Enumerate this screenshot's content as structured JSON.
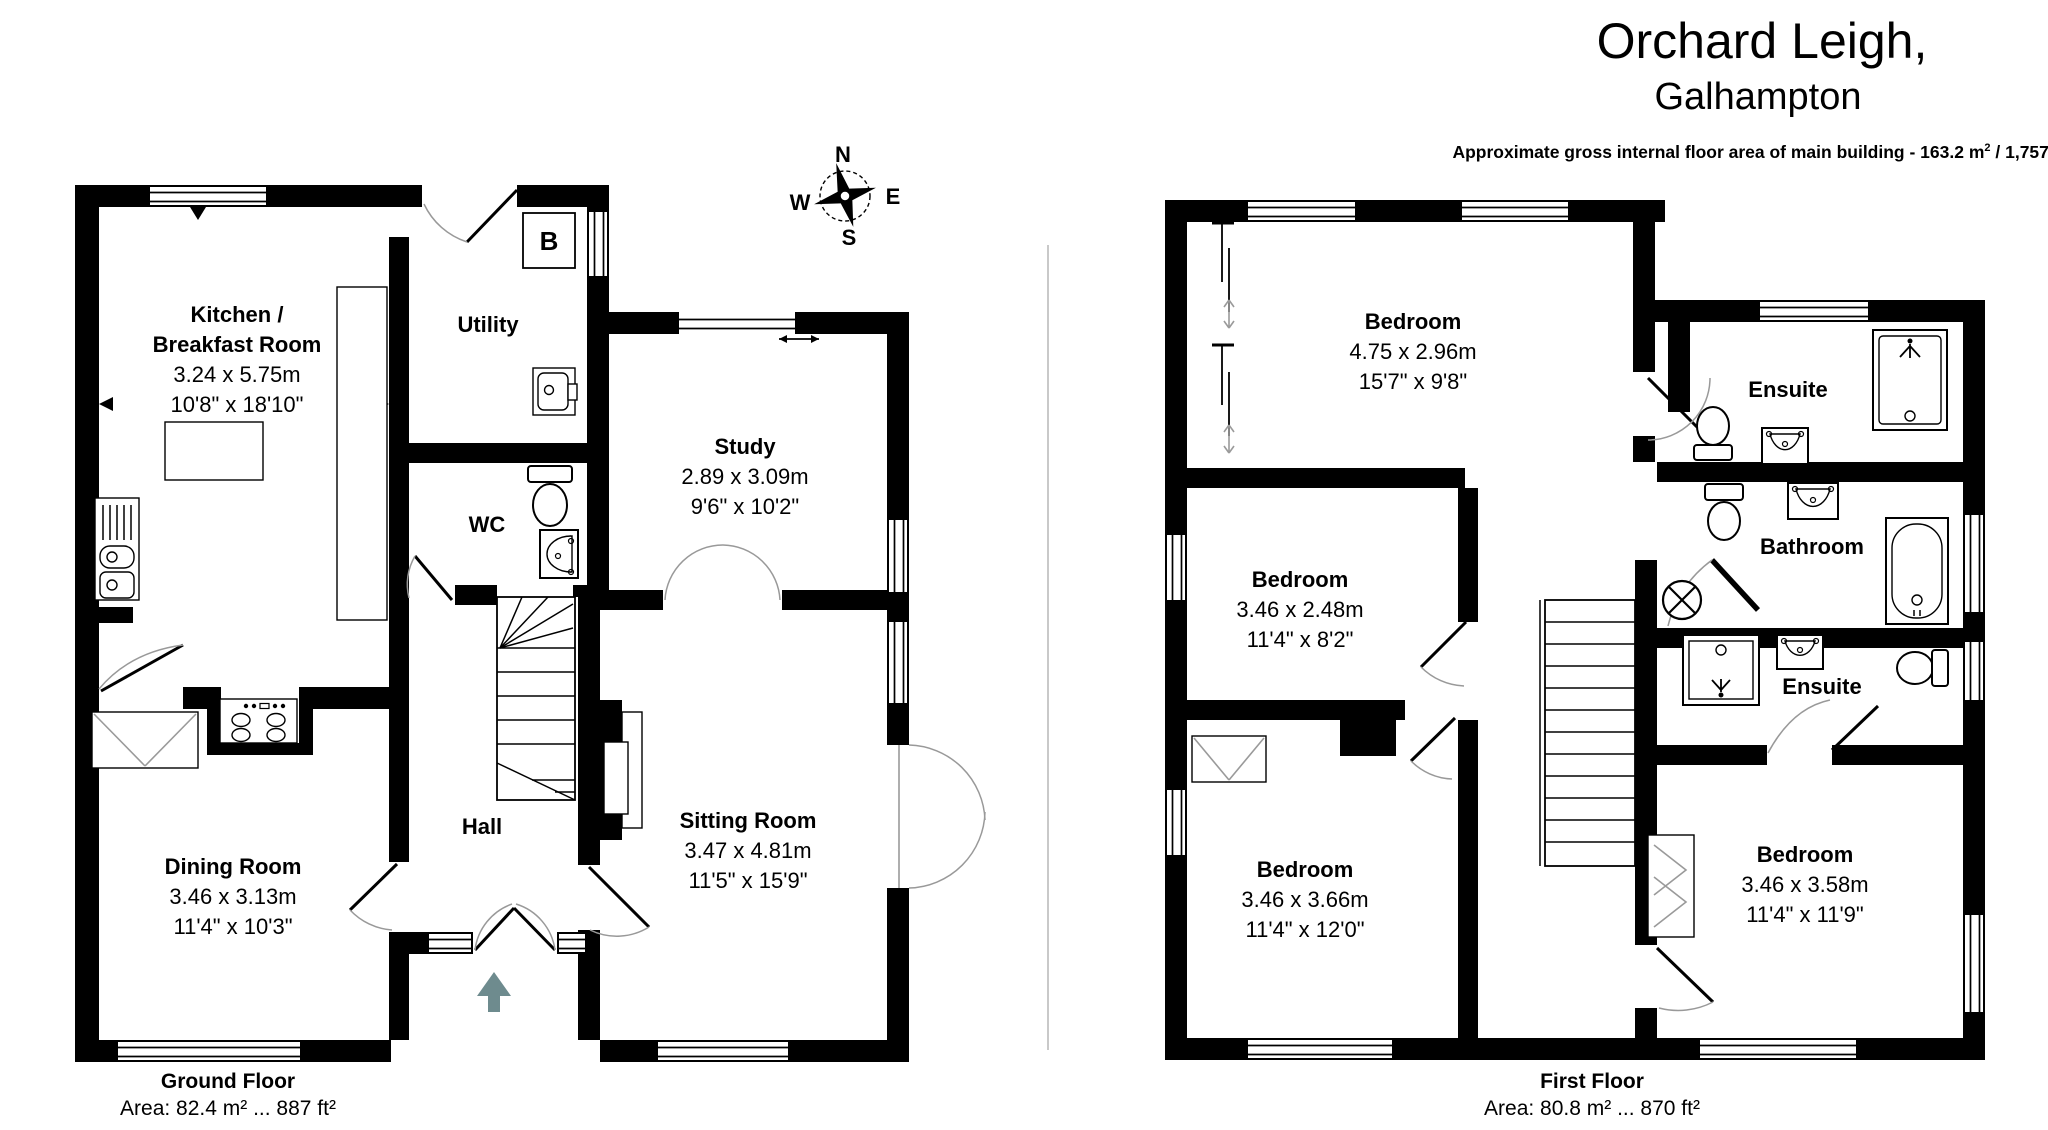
{
  "header": {
    "title_line1": "Orchard Leigh,",
    "title_line2": "Galhampton",
    "area_note": {
      "p1": "Approximate gross internal floor area of main building  -  163.2 m",
      "sup1": "2",
      "p2": " /  1,757 ft",
      "sup2": "2"
    }
  },
  "compass": {
    "north": "N",
    "east": "E",
    "south": "S",
    "west": "W"
  },
  "ground_floor": {
    "caption": "Ground Floor",
    "area": "Area: 82.4 m² ... 887 ft²",
    "boiler": "B",
    "rooms": {
      "kitchen": {
        "name1": "Kitchen /",
        "name2": "Breakfast Room",
        "metric": "3.24 x 5.75m",
        "imperial": "10'8\" x 18'10\""
      },
      "utility": {
        "name": "Utility"
      },
      "study": {
        "name": "Study",
        "metric": "2.89 x 3.09m",
        "imperial": "9'6\" x 10'2\""
      },
      "wc": {
        "name": "WC"
      },
      "hall": {
        "name": "Hall"
      },
      "dining": {
        "name": "Dining Room",
        "metric": "3.46 x 3.13m",
        "imperial": "11'4\" x 10'3\""
      },
      "sitting": {
        "name": "Sitting Room",
        "metric": "3.47 x 4.81m",
        "imperial": "11'5\" x 15'9\""
      }
    }
  },
  "first_floor": {
    "caption": "First Floor",
    "area": "Area: 80.8 m² ... 870 ft²",
    "rooms": {
      "bedroom1": {
        "name": "Bedroom",
        "metric": "4.75 x 2.96m",
        "imperial": "15'7\" x 9'8\""
      },
      "ensuite1": {
        "name": "Ensuite"
      },
      "bathroom": {
        "name": "Bathroom"
      },
      "ensuite2": {
        "name": "Ensuite"
      },
      "bedroom2": {
        "name": "Bedroom",
        "metric": "3.46 x 2.48m",
        "imperial": "11'4\" x 8'2\""
      },
      "bedroom3": {
        "name": "Bedroom",
        "metric": "3.46 x 3.66m",
        "imperial": "11'4\" x 12'0\""
      },
      "bedroom4": {
        "name": "Bedroom",
        "metric": "3.46 x 3.58m",
        "imperial": "11'4\" x 11'9\""
      }
    }
  },
  "colors": {
    "wall": "#000000",
    "entrance_arrow": "#6e8b8e",
    "divider": "#c9c9c9"
  }
}
